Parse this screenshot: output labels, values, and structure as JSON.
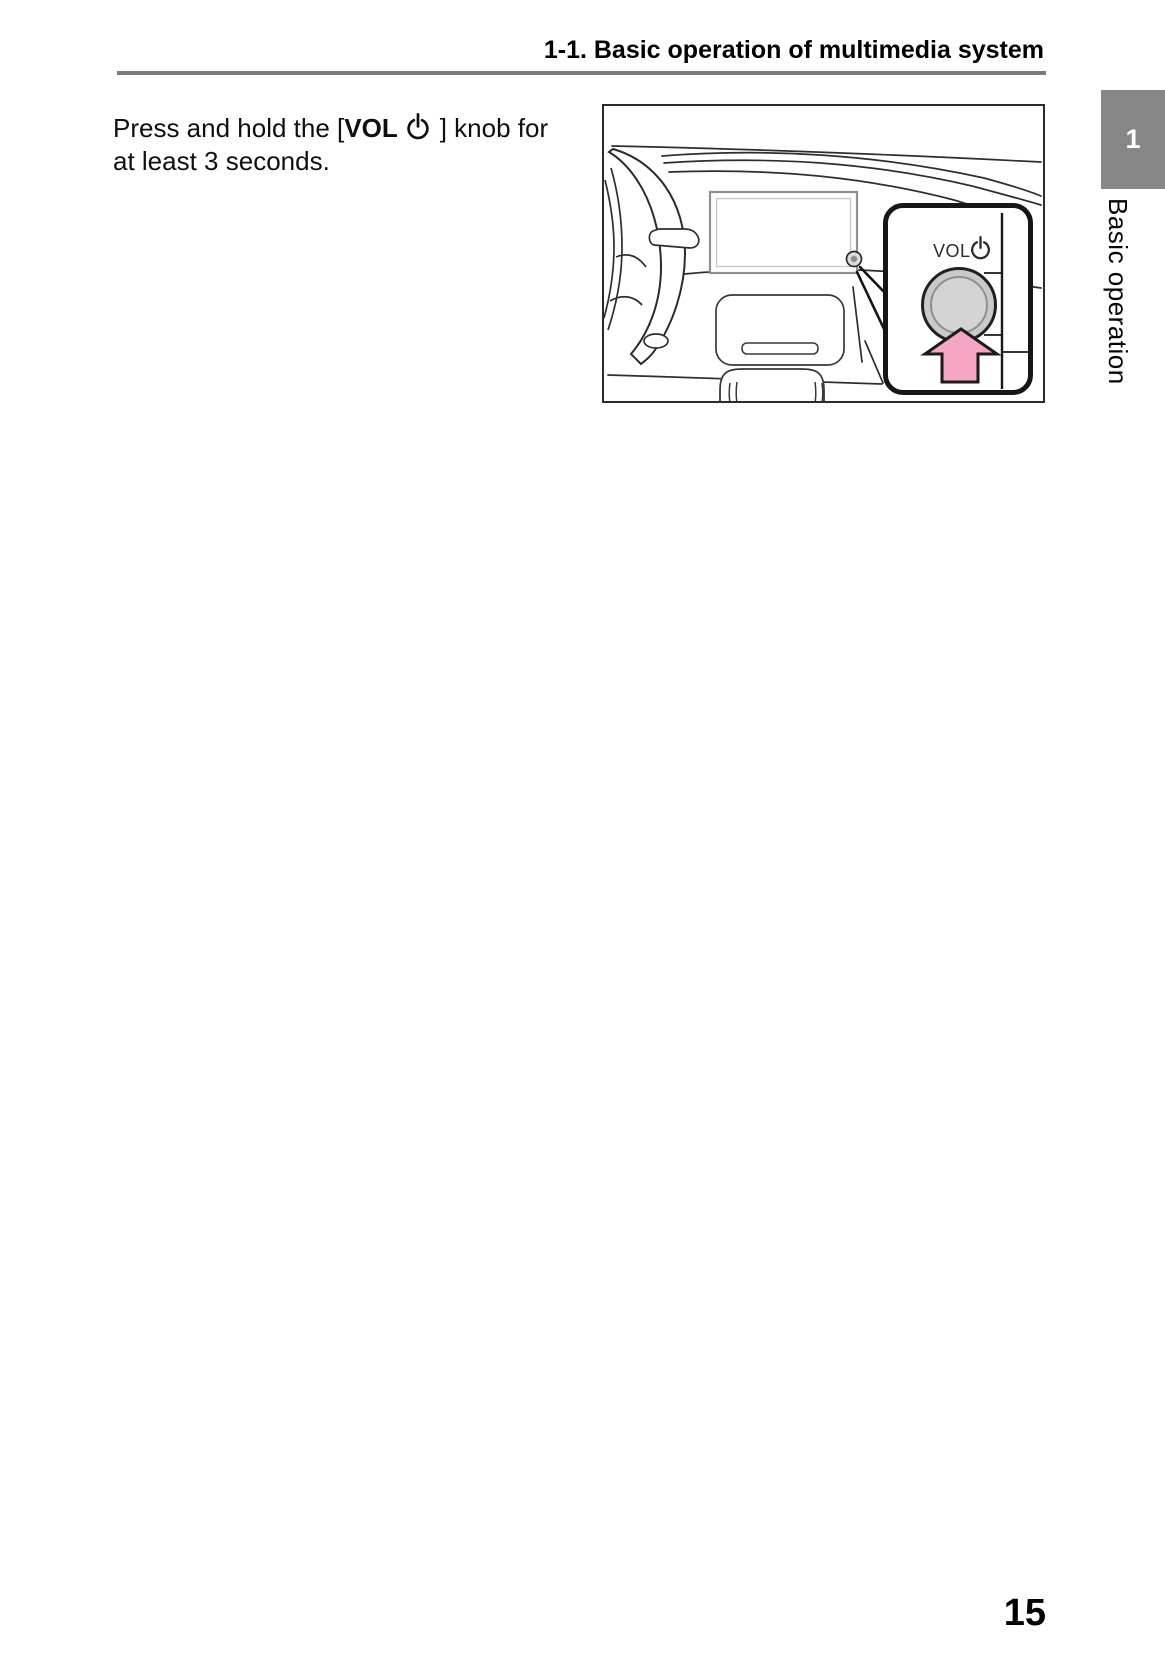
{
  "document": {
    "header_title": "1-1. Basic operation of multimedia system",
    "page_number": "15"
  },
  "sidebar": {
    "chapter_number": "1",
    "chapter_title": "Basic operation"
  },
  "instruction": {
    "line1_prefix": "Press and hold the [",
    "vol_label": "VOL",
    "line1_suffix": "] knob for",
    "line2": "at least 3 seconds."
  },
  "illustration": {
    "callout_knob_label": "VOL",
    "icons": {
      "power": "power-icon",
      "press_arrow": "up-arrow-icon"
    }
  },
  "colors": {
    "header_rule": "#7b7b7b",
    "chapter_tab_bg": "#878787",
    "arrow_pink": "#f4a6c2",
    "arrow_outline": "#1b1b1b",
    "knob_gray": "#c9c9c9"
  }
}
